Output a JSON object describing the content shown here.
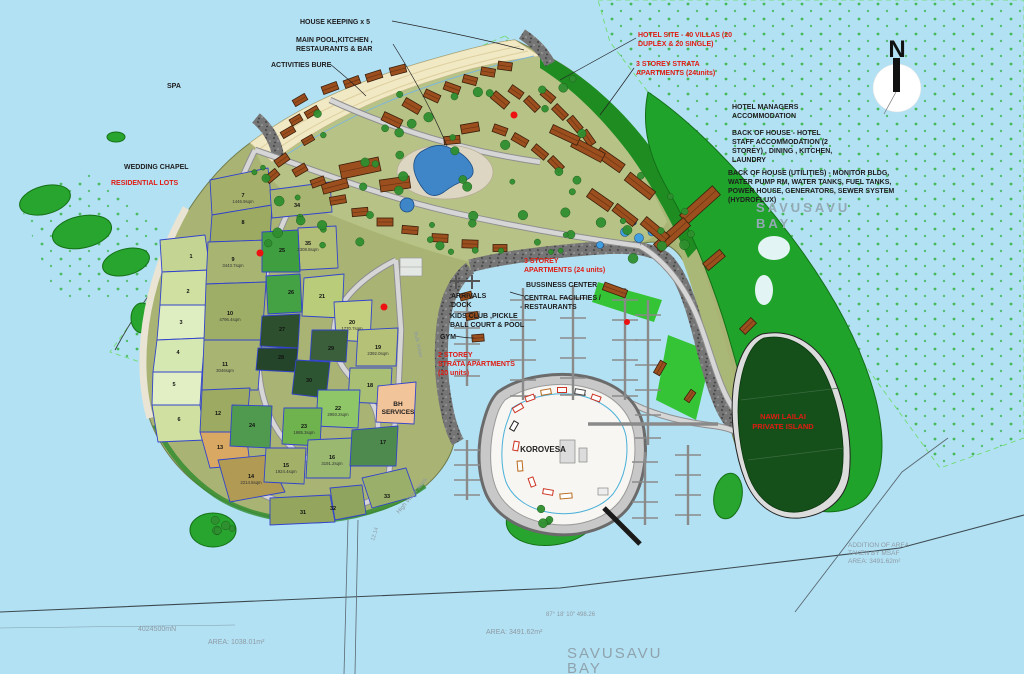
{
  "map": {
    "compass": {
      "letter": "N"
    },
    "colors": {
      "water": "#b3e1f4",
      "land": "#a9b474",
      "hotel_zone": "#b7c286",
      "coastal_forest": "#1f8c22",
      "green_hill": "#1fa32a",
      "nawi_island": "#15501a",
      "beach": "#f1e8c4",
      "road": "#d6d6d6",
      "riprap": "#6f6f6f",
      "lot_border": "#3344cc",
      "marina_island": "#f7f6f2",
      "pier": "#8a8a8a",
      "reef_dots": "#3ab54a",
      "label_black": "#1d1d1d",
      "label_red": "#e01b12",
      "label_gray": "#8d9aa2"
    },
    "labels": [
      {
        "id": "housekeeping",
        "text": "HOUSE KEEPING x 5",
        "x": 300,
        "y": 24,
        "c": "black",
        "s": 7,
        "b": 1
      },
      {
        "id": "main-pool-1",
        "text": "MAIN POOL,KITCHEN ,",
        "x": 296,
        "y": 42,
        "c": "black",
        "s": 7,
        "b": 1
      },
      {
        "id": "main-pool-2",
        "text": "RESTAURANTS & BAR",
        "x": 296,
        "y": 51,
        "c": "black",
        "s": 7,
        "b": 1
      },
      {
        "id": "activities-bure",
        "text": "ACTIVITIES BURE",
        "x": 271,
        "y": 67,
        "c": "black",
        "s": 7,
        "b": 1
      },
      {
        "id": "spa",
        "text": "SPA",
        "x": 167,
        "y": 88,
        "c": "black",
        "s": 7,
        "b": 1
      },
      {
        "id": "wedding-chapel",
        "text": "WEDDING CHAPEL",
        "x": 124,
        "y": 169,
        "c": "black",
        "s": 7,
        "b": 1
      },
      {
        "id": "residential-lots",
        "text": "RESIDENTIAL LOTS",
        "x": 111,
        "y": 185,
        "c": "red",
        "s": 7,
        "b": 1
      },
      {
        "id": "hotel-site-1",
        "text": "HOTEL SITE - 40 VILLAS (20",
        "x": 638,
        "y": 37,
        "c": "red",
        "s": 7,
        "b": 1
      },
      {
        "id": "hotel-site-2",
        "text": "DUPLEX & 20 SINGLE)",
        "x": 638,
        "y": 46,
        "c": "red",
        "s": 7,
        "b": 1
      },
      {
        "id": "strata3-1",
        "text": "3 STOREY STRATA",
        "x": 636,
        "y": 66,
        "c": "red",
        "s": 7,
        "b": 1
      },
      {
        "id": "strata3-2",
        "text": "APARTMENTS (24units)",
        "x": 636,
        "y": 75,
        "c": "red",
        "s": 7,
        "b": 1
      },
      {
        "id": "hotel-mgr-1",
        "text": "HOTEL MANAGERS",
        "x": 732,
        "y": 109,
        "c": "black",
        "s": 7,
        "b": 1
      },
      {
        "id": "hotel-mgr-2",
        "text": "ACCOMMODATION",
        "x": 732,
        "y": 118,
        "c": "black",
        "s": 7,
        "b": 1
      },
      {
        "id": "boh-1",
        "text": "BACK OF HOUSE - HOTEL",
        "x": 732,
        "y": 135,
        "c": "black",
        "s": 7,
        "b": 1
      },
      {
        "id": "boh-2",
        "text": "STAFF ACCOMMODATION (2",
        "x": 732,
        "y": 144,
        "c": "black",
        "s": 7,
        "b": 1
      },
      {
        "id": "boh-3",
        "text": "STOREY) , DINING , KITCHEN,",
        "x": 732,
        "y": 153,
        "c": "black",
        "s": 7,
        "b": 1
      },
      {
        "id": "boh-4",
        "text": "LAUNDRY",
        "x": 732,
        "y": 162,
        "c": "black",
        "s": 7,
        "b": 1
      },
      {
        "id": "boh-util-1",
        "text": "BACK OF HOUSE (UTILITIES) - MONITOR BLDG,",
        "x": 728,
        "y": 175,
        "c": "black",
        "s": 7,
        "b": 1
      },
      {
        "id": "boh-util-2",
        "text": "WATER PUMP RM, WATER TANKS, FUEL TANKS,",
        "x": 728,
        "y": 184,
        "c": "black",
        "s": 7,
        "b": 1
      },
      {
        "id": "boh-util-3",
        "text": "POWER HOUSE, GENERATORS, SEWER SYSTEM",
        "x": 728,
        "y": 193,
        "c": "black",
        "s": 7,
        "b": 1
      },
      {
        "id": "boh-util-4",
        "text": "(HYDROFLUX)",
        "x": 728,
        "y": 202,
        "c": "black",
        "s": 7,
        "b": 1
      },
      {
        "id": "bay-wm1a",
        "text": "SAVUSAVU",
        "x": 756,
        "y": 212,
        "c": "wm",
        "s": 13,
        "b": 1,
        "ls": 3
      },
      {
        "id": "bay-wm1b",
        "text": "BAY",
        "x": 756,
        "y": 228,
        "c": "wm",
        "s": 13,
        "b": 1,
        "ls": 3
      },
      {
        "id": "apts3-1",
        "text": "3 STOREY",
        "x": 524,
        "y": 263,
        "c": "red",
        "s": 7,
        "b": 1
      },
      {
        "id": "apts3-2",
        "text": "APARTMENTS (24 units)",
        "x": 524,
        "y": 272,
        "c": "red",
        "s": 7,
        "b": 1
      },
      {
        "id": "bussiness-center",
        "text": "BUSSINESS CENTER",
        "x": 526,
        "y": 287,
        "c": "black",
        "s": 7,
        "b": 1
      },
      {
        "id": "central-fac-1",
        "text": "CENTRAL  FACILITIES /",
        "x": 524,
        "y": 300,
        "c": "black",
        "s": 7,
        "b": 1
      },
      {
        "id": "central-fac-2",
        "text": "- RESTAURANTS",
        "x": 520,
        "y": 309,
        "c": "black",
        "s": 7,
        "b": 1
      },
      {
        "id": "arrivals-1",
        "text": "ARRIVALS",
        "x": 451,
        "y": 298,
        "c": "black",
        "s": 7,
        "b": 1
      },
      {
        "id": "arrivals-2",
        "text": "DOCK",
        "x": 451,
        "y": 307,
        "c": "black",
        "s": 7,
        "b": 1
      },
      {
        "id": "kids-club-1",
        "text": "KIDS CLUB ,PICKLE",
        "x": 450,
        "y": 318,
        "c": "black",
        "s": 7,
        "b": 1
      },
      {
        "id": "kids-club-2",
        "text": "BALL COURT & POOL",
        "x": 450,
        "y": 327,
        "c": "black",
        "s": 7,
        "b": 1
      },
      {
        "id": "gym",
        "text": "GYM",
        "x": 440,
        "y": 339,
        "c": "black",
        "s": 7,
        "b": 1
      },
      {
        "id": "strata2-1",
        "text": "2 STOREY",
        "x": 438,
        "y": 357,
        "c": "red",
        "s": 7,
        "b": 1
      },
      {
        "id": "strata2-2",
        "text": "STRATA APARTMENTS",
        "x": 438,
        "y": 366,
        "c": "red",
        "s": 7,
        "b": 1
      },
      {
        "id": "strata2-3",
        "text": "(20 units)",
        "x": 438,
        "y": 375,
        "c": "red",
        "s": 7,
        "b": 1
      },
      {
        "id": "korovesa",
        "text": "KOROVESA",
        "x": 543,
        "y": 452,
        "c": "black",
        "s": 8,
        "b": 1,
        "a": "middle"
      },
      {
        "id": "bh-1",
        "text": "BH",
        "x": 398,
        "y": 406,
        "c": "black",
        "s": 6.5,
        "b": 1,
        "a": "middle"
      },
      {
        "id": "bh-2",
        "text": "SERVICES",
        "x": 398,
        "y": 414,
        "c": "black",
        "s": 6.5,
        "b": 1,
        "a": "middle"
      },
      {
        "id": "nawi-1",
        "text": "NAWI LAILAI",
        "x": 783,
        "y": 419,
        "c": "red",
        "s": 7.5,
        "b": 1,
        "a": "middle"
      },
      {
        "id": "nawi-2",
        "text": "PRIVATE ISLAND",
        "x": 783,
        "y": 429,
        "c": "red",
        "s": 7.5,
        "b": 1,
        "a": "middle"
      },
      {
        "id": "msaf-1",
        "text": "ADDITION OF AREA",
        "x": 848,
        "y": 547,
        "c": "gray",
        "s": 6.5
      },
      {
        "id": "msaf-2",
        "text": "TAKEN BY MSAF",
        "x": 848,
        "y": 555,
        "c": "gray",
        "s": 6.5
      },
      {
        "id": "msaf-3",
        "text": "AREA: 3491.62m²",
        "x": 848,
        "y": 563,
        "c": "gray",
        "s": 6.5
      },
      {
        "id": "area-1038",
        "text": "AREA: 1038.01m²",
        "x": 208,
        "y": 644,
        "c": "gray",
        "s": 7
      },
      {
        "id": "grid-n",
        "text": "4024500mN",
        "x": 138,
        "y": 631,
        "c": "gray",
        "s": 7
      },
      {
        "id": "bearing",
        "text": "87°  18'  10\"      498.26",
        "x": 546,
        "y": 616,
        "c": "gray",
        "s": 6
      },
      {
        "id": "area-3491",
        "text": "AREA: 3491.62m²",
        "x": 486,
        "y": 634,
        "c": "gray",
        "s": 7
      },
      {
        "id": "bay-wm2a",
        "text": "SAVUSAVU",
        "x": 567,
        "y": 658,
        "c": "wm2",
        "s": 15,
        "ls": 2
      },
      {
        "id": "bay-wm2b",
        "text": "BAY",
        "x": 567,
        "y": 673,
        "c": "wm2",
        "s": 15,
        "ls": 2
      },
      {
        "id": "high-water-mark",
        "text": "High Water Mark",
        "x": 399,
        "y": 514,
        "c": "gray",
        "s": 6,
        "rot": -50
      },
      {
        "id": "bulk-water-road",
        "text": "Bulk Water",
        "x": 414,
        "y": 332,
        "c": "gray",
        "s": 5.5,
        "rot": 78
      },
      {
        "id": "dim-12-14",
        "text": "12.14",
        "x": 374,
        "y": 541,
        "c": "gray",
        "s": 5.5,
        "rot": -72
      }
    ],
    "lots": [
      {
        "n": "1",
        "x": 191,
        "y": 258
      },
      {
        "n": "2",
        "x": 188,
        "y": 293
      },
      {
        "n": "3",
        "x": 181,
        "y": 324
      },
      {
        "n": "4",
        "x": 178,
        "y": 354
      },
      {
        "n": "5",
        "x": 174,
        "y": 386
      },
      {
        "n": "6",
        "x": 179,
        "y": 421
      },
      {
        "n": "7",
        "x": 243,
        "y": 197,
        "area": "1446.9sqm"
      },
      {
        "n": "8",
        "x": 243,
        "y": 224
      },
      {
        "n": "9",
        "x": 233,
        "y": 261,
        "area": "3443.7sqm"
      },
      {
        "n": "10",
        "x": 230,
        "y": 315,
        "area": "4796.4sqm"
      },
      {
        "n": "11",
        "x": 225,
        "y": 366,
        "area": "3046sqm"
      },
      {
        "n": "12",
        "x": 218,
        "y": 415
      },
      {
        "n": "13",
        "x": 220,
        "y": 449
      },
      {
        "n": "14",
        "x": 251,
        "y": 478,
        "area": "2214.5sqm"
      },
      {
        "n": "15",
        "x": 286,
        "y": 467,
        "area": "1924.4sqm"
      },
      {
        "n": "16",
        "x": 332,
        "y": 459,
        "area": "3191.2sqm"
      },
      {
        "n": "17",
        "x": 383,
        "y": 444
      },
      {
        "n": "18",
        "x": 370,
        "y": 387
      },
      {
        "n": "19",
        "x": 378,
        "y": 349,
        "area": "2392.0sqm"
      },
      {
        "n": "20",
        "x": 352,
        "y": 324,
        "area": "1770.7sqm"
      },
      {
        "n": "21",
        "x": 322,
        "y": 298
      },
      {
        "n": "22",
        "x": 338,
        "y": 410,
        "area": "2993.2sqm"
      },
      {
        "n": "23",
        "x": 304,
        "y": 428,
        "area": "1985.3sqm"
      },
      {
        "n": "24",
        "x": 252,
        "y": 427
      },
      {
        "n": "25",
        "x": 282,
        "y": 252
      },
      {
        "n": "26",
        "x": 291,
        "y": 294
      },
      {
        "n": "27",
        "x": 282,
        "y": 331
      },
      {
        "n": "28",
        "x": 281,
        "y": 359
      },
      {
        "n": "29",
        "x": 331,
        "y": 350
      },
      {
        "n": "30",
        "x": 309,
        "y": 382
      },
      {
        "n": "31",
        "x": 303,
        "y": 514
      },
      {
        "n": "32",
        "x": 333,
        "y": 510
      },
      {
        "n": "33",
        "x": 387,
        "y": 498
      },
      {
        "n": "34",
        "x": 297,
        "y": 207
      },
      {
        "n": "35",
        "x": 308,
        "y": 245,
        "area": "2308.8sqm"
      }
    ]
  }
}
